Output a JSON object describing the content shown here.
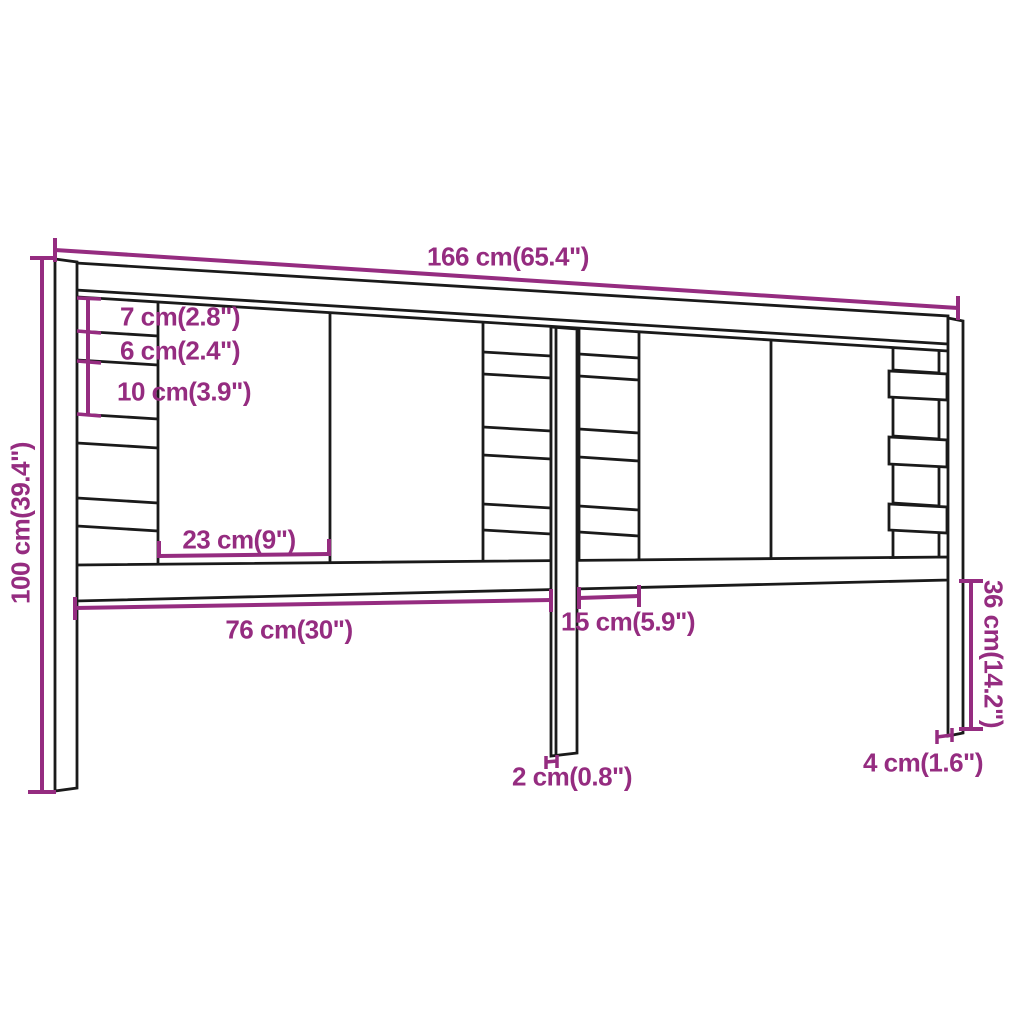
{
  "diagram": {
    "kind": "furniture-dimension-drawing",
    "product": "slatted headboard with posts",
    "colors": {
      "dimension": "#952c80",
      "outline": "#1a1a1a",
      "background": "#ffffff"
    },
    "labels": {
      "width_total": "166 cm(65.4\")",
      "height_total": "100 cm(39.4\")",
      "top_gap": "7 cm(2.8\")",
      "slat_height": "6 cm(2.4\")",
      "mid_gap": "10 cm(3.9\")",
      "board_width": "23 cm(9\")",
      "left_span": "76 cm(30\")",
      "strip_width": "15 cm(5.9\")",
      "center_leg_thickness": "2 cm(0.8\")",
      "post_thickness": "4 cm(1.6\")",
      "leg_height": "36 cm(14.2\")"
    }
  }
}
